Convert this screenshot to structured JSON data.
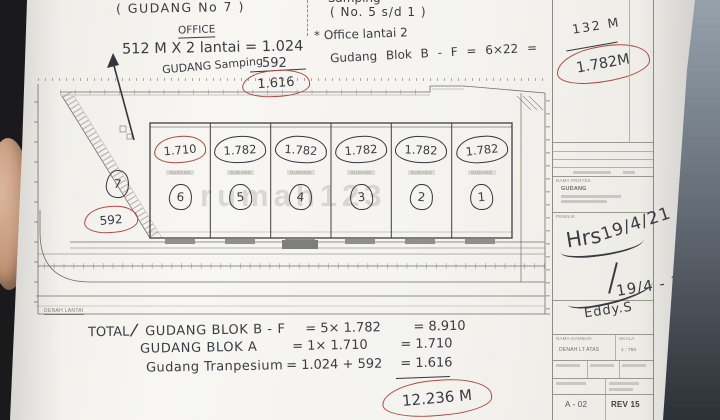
{
  "notes_left": {
    "header": "( GUDANG No 7 )",
    "office": "OFFICE",
    "formula": "512 M X 2 lantai = 1.024",
    "plus_value": "592",
    "side_label": "GUDANG Samping",
    "subtotal": "1.616"
  },
  "notes_right": {
    "clipped_line": "* Samping",
    "range_line": "( No. 5 s/d 1 )",
    "office_line": "* Office lantai 2",
    "calc_line": "Gudang Blok B - F  =  6×22  =",
    "calc_result": "132 M",
    "block_total": "1.782M"
  },
  "plan": {
    "caption": "DENAH LANTAI",
    "bay_label": "GUDANG",
    "bays": [
      {
        "area": "1.710",
        "no": "6"
      },
      {
        "area": "1.782",
        "no": "5"
      },
      {
        "area": "1.782",
        "no": "4"
      },
      {
        "area": "1.782",
        "no": "3"
      },
      {
        "area": "1.782",
        "no": "2"
      },
      {
        "area": "1.782",
        "no": "1"
      }
    ],
    "trapezium_no": "7",
    "trapezium_area": "592"
  },
  "totals": {
    "title": "TOTAL",
    "rows": [
      {
        "label": "GUDANG BLOK B - F",
        "calc": "= 5× 1.782",
        "result": "= 8.910"
      },
      {
        "label": "GUDANG BLOK A",
        "calc": "= 1× 1.710",
        "result": "= 1.710"
      },
      {
        "label": "Gudang Tranpesium",
        "calc": "= 1.024 + 592",
        "result": "= 1.616"
      }
    ],
    "grand_total": "12.236 M"
  },
  "title_block": {
    "project_label": "NAMA PROYEK",
    "project_name": "GUDANG",
    "owner_label": "PEMILIK",
    "sig1": "Hrs",
    "date1": "19/4/21",
    "sig2": "Eddy.S",
    "date2": "19/4 - 21",
    "drawing_label": "NAMA GAMBAR",
    "drawing_name": "DENAH LT ATAS",
    "scale_label": "SKALA",
    "scale_value": "1 : 750",
    "sheet_no": "A - 02",
    "rev_no": "REV 15"
  },
  "watermark": "rumah123"
}
